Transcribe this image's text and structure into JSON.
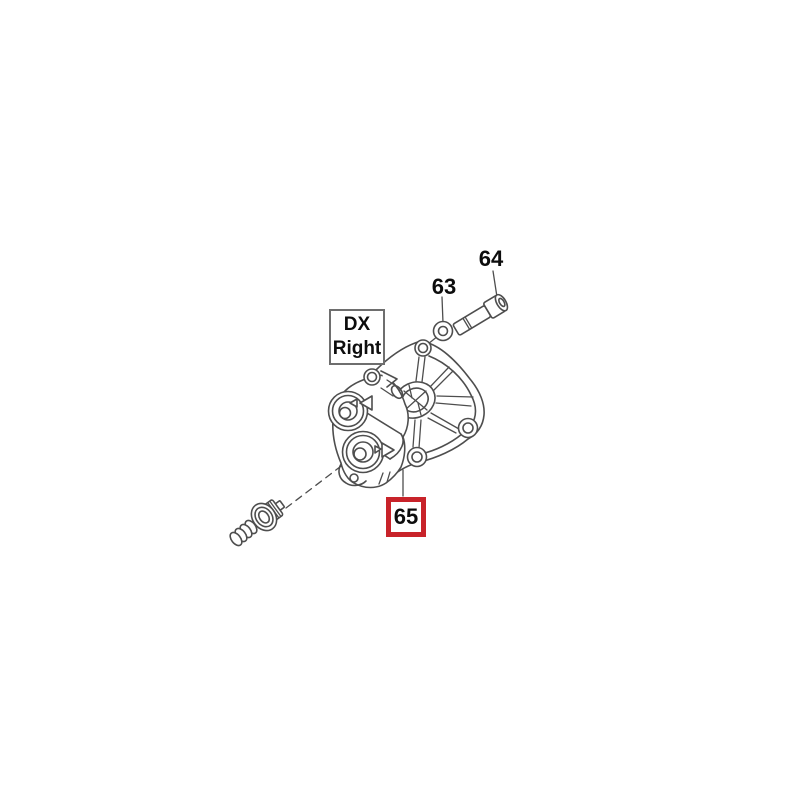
{
  "colors": {
    "line": "#4e4e4e",
    "text": "#0d0d0d",
    "highlight_border": "#c8232a",
    "label_box_border": "#6e6e6e",
    "background": "#ffffff"
  },
  "orientation_label": {
    "line1": "DX",
    "line2": "Right"
  },
  "callouts": [
    {
      "number": "63"
    },
    {
      "number": "64"
    },
    {
      "number": "65",
      "highlighted": true
    }
  ]
}
